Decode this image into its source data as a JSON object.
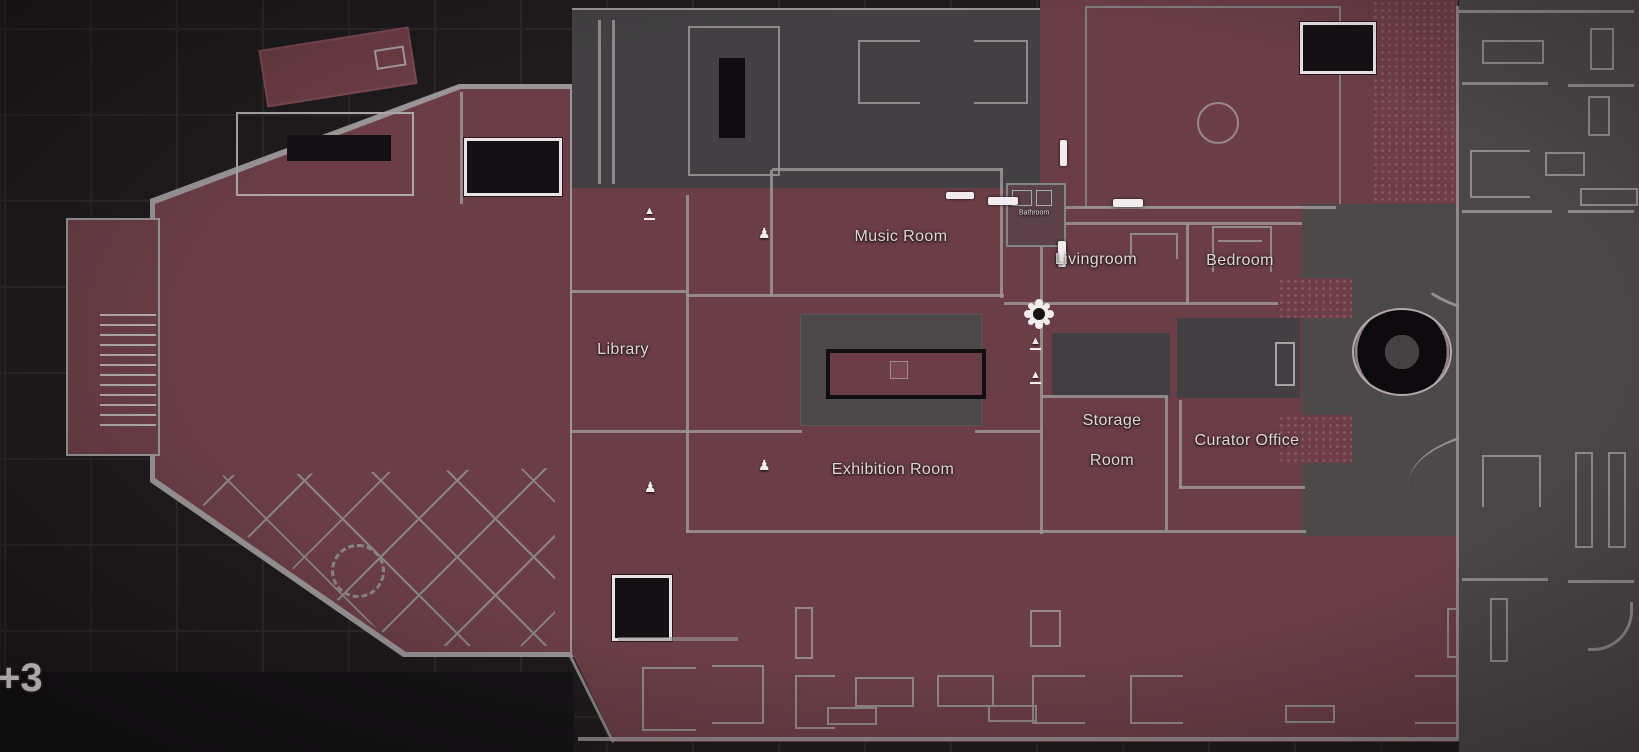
{
  "map": {
    "floor_label": "+3",
    "colors": {
      "bg": "#1e1b1d",
      "grid": "#2d272a",
      "red": "#6b3e47",
      "red_dark": "#5f3840",
      "gray": "#4b484a",
      "gray_dark": "#424042",
      "garden": "#4a4749",
      "wall": "#9b9598",
      "white": "#f2ecee",
      "black": "#141114",
      "label": "#dcd7d9"
    },
    "rooms": [
      {
        "id": "music-room",
        "label": "Music Room"
      },
      {
        "id": "bathroom",
        "label": "Bathroom"
      },
      {
        "id": "livingroom",
        "label": "Livingroom"
      },
      {
        "id": "bedroom",
        "label": "Bedroom"
      },
      {
        "id": "library",
        "label": "Library"
      },
      {
        "id": "storage-room",
        "label_line1": "Storage",
        "label_line2": "Room"
      },
      {
        "id": "curator-office",
        "label": "Curator Office"
      },
      {
        "id": "exhibition-room",
        "label": "Exhibition Room"
      }
    ],
    "icons": {
      "player_marker": "flower-gear-position-marker",
      "stairs_glyph": "▲",
      "statue_glyph": "♟"
    }
  }
}
